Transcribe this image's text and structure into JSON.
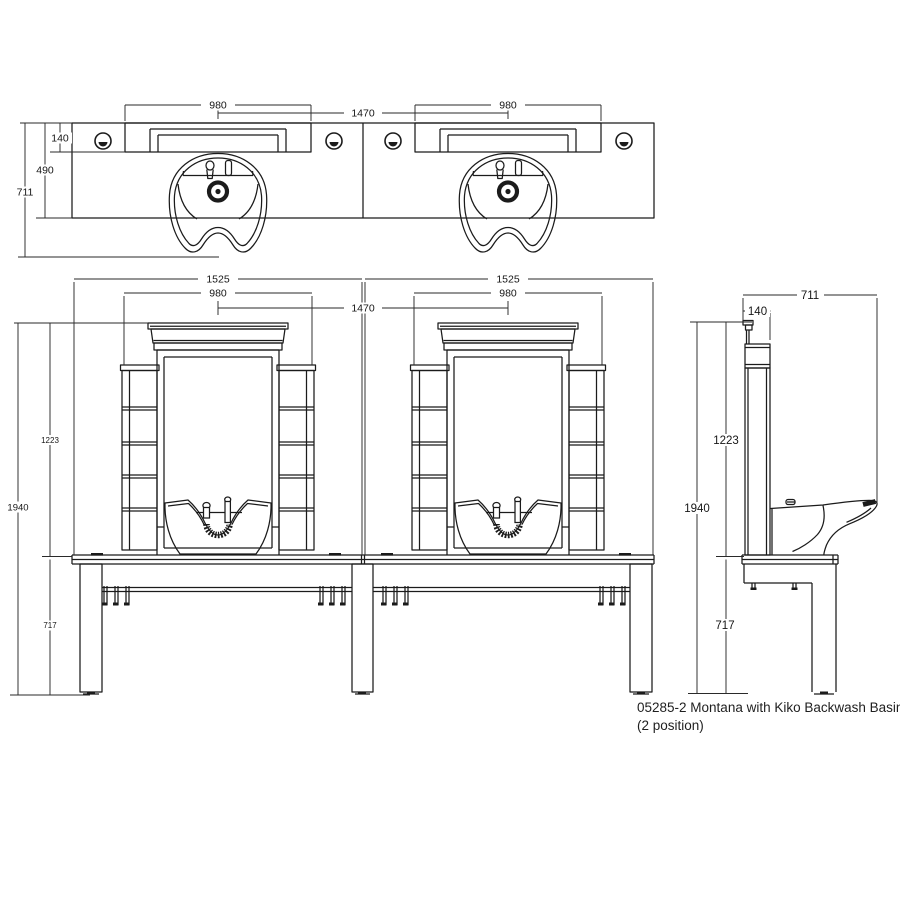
{
  "drawing": {
    "caption_line1": "05285-2 Montana with Kiko Backwash Basin",
    "caption_line2": "(2 position)",
    "line_color": "#1b1b1b",
    "background": "#ffffff"
  },
  "plan_view": {
    "dim_shelf_width_left": "980",
    "dim_basin_centres": "1470",
    "dim_shelf_width_right": "980",
    "dim_shelf_depth": "140",
    "dim_worktop_depth": "490",
    "dim_overall_depth": "711"
  },
  "front_view": {
    "dim_unit_width_left": "1525",
    "dim_mirror_width_left": "980",
    "dim_basin_centres": "1470",
    "dim_unit_width_right": "1525",
    "dim_mirror_width_right": "980",
    "dim_upper_height": "1223",
    "dim_overall_height": "1940",
    "dim_worktop_height": "717"
  },
  "side_view": {
    "dim_overall_depth": "711",
    "dim_panel_depth": "140",
    "dim_upper_height": "1223",
    "dim_overall_height": "1940",
    "dim_worktop_height": "717"
  }
}
